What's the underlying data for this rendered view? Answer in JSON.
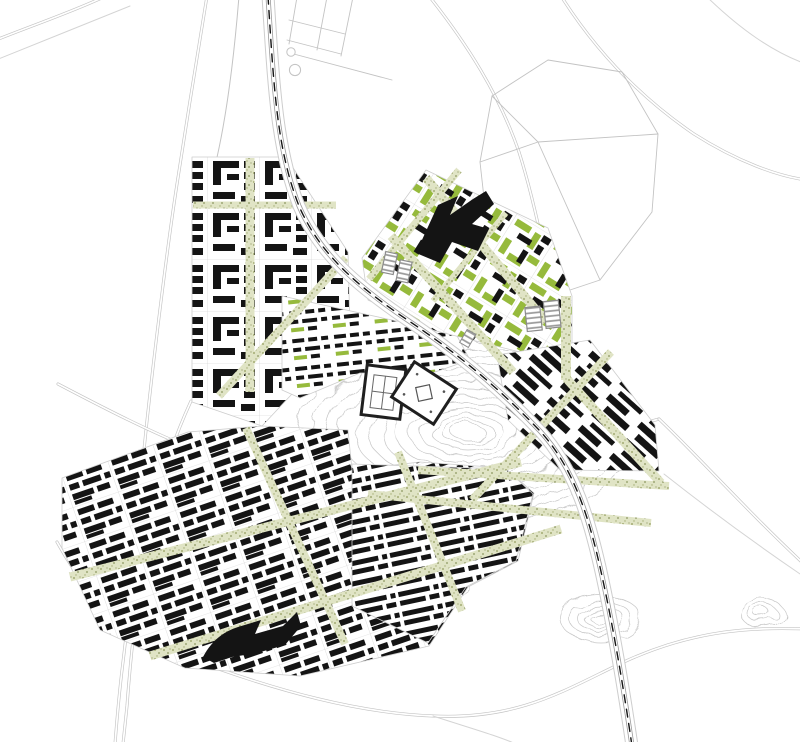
{
  "map": {
    "kind": "urban-masterplan-figure-ground",
    "layers": [
      "context-road-network",
      "river",
      "topographic-contours",
      "district-upper-left",
      "district-central",
      "district-northeast-green",
      "district-east",
      "district-lower",
      "district-rowhousing",
      "green-boulevards",
      "railway",
      "landmark-buildings"
    ]
  },
  "colors": {
    "white": "#ffffff",
    "building": "#141414",
    "green_building": "#96ba3c",
    "strip_bg": "#e0e4c5",
    "strip_dot": "#a3ac73",
    "strip_dot2": "#8b955e",
    "road": "#c3c3c3",
    "road_faint": "#d4d4d4",
    "parcel": "#cdcdcd",
    "contour": "#c7c7c7",
    "rail_edge": "#9a9a9a",
    "rail_dash": "#141414",
    "shed_stripe": "#999999",
    "shed_outline": "#8c8c8c",
    "landmark_outline": "#1f1f1f",
    "inner_gray": "#666666",
    "dot_gray": "#555555"
  }
}
